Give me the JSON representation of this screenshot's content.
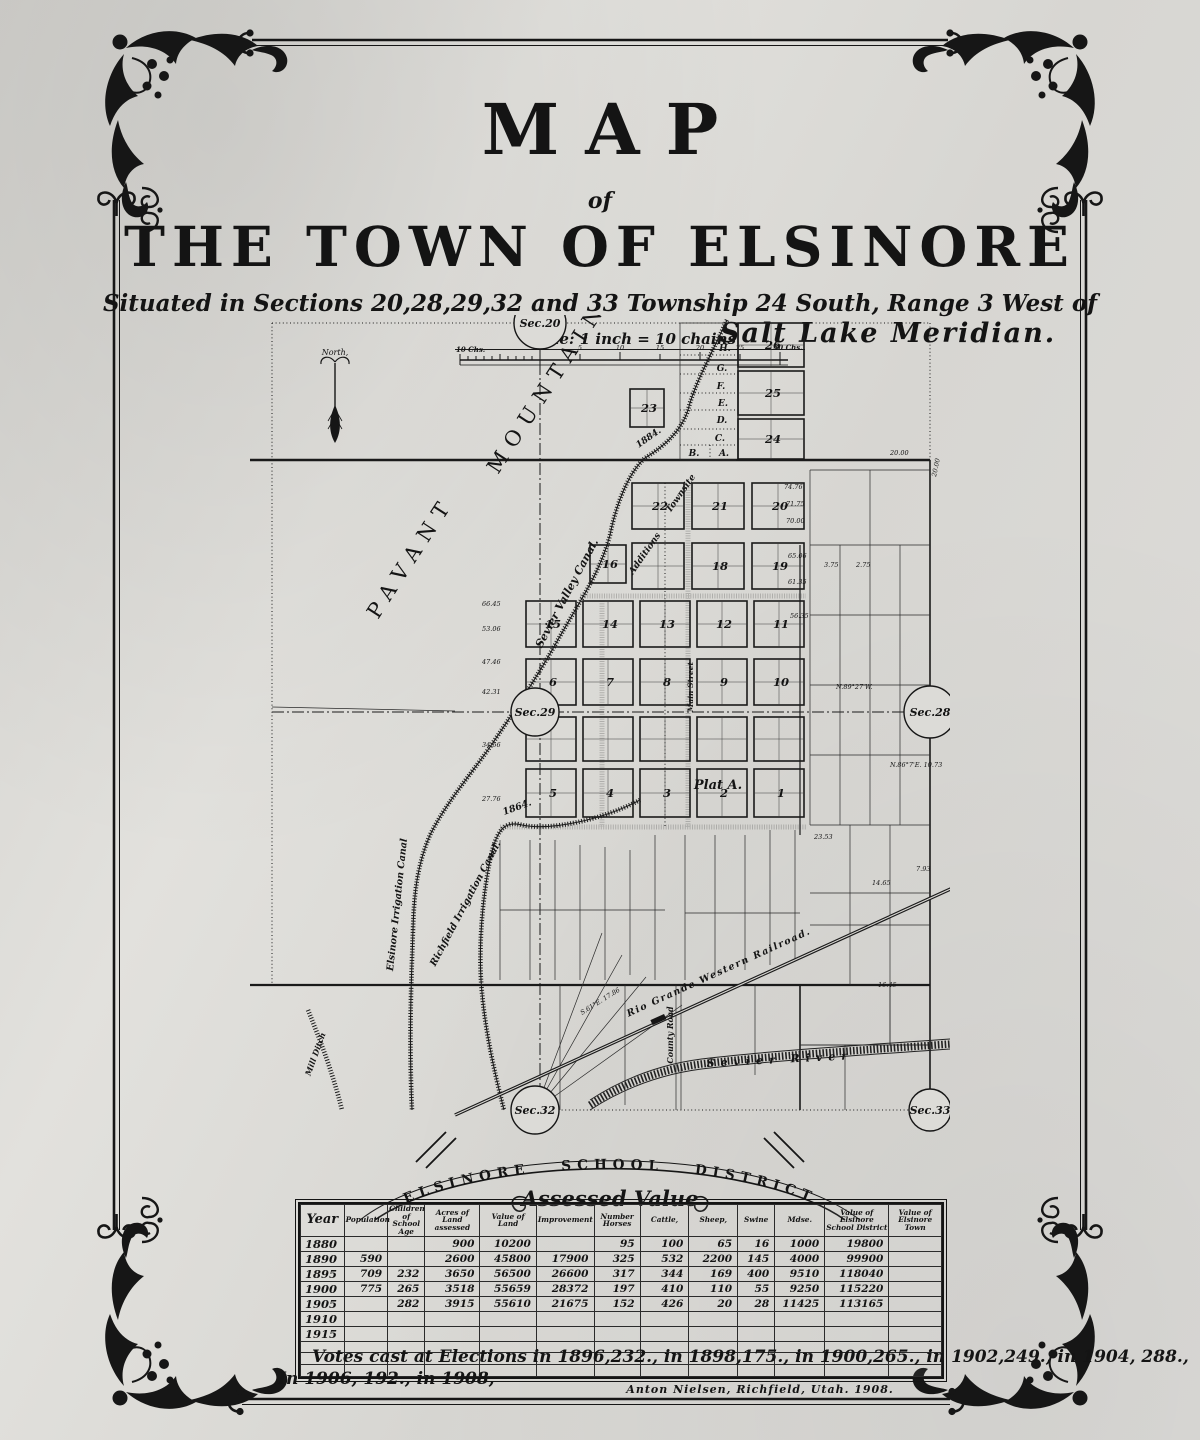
{
  "title": {
    "map": "MAP",
    "of": "of",
    "town": "THE TOWN OF ELSINORE"
  },
  "subtitle": {
    "line1": "Situated in Sections 20,28,29,32 and 33 Township 24 South, Range 3 West of",
    "line2": "Salt Lake Meridian."
  },
  "scale": {
    "label": "Scale: 1 inch = 10 chains",
    "left_end": "10 Chs.",
    "ticks": [
      "0",
      "5",
      "10",
      "15",
      "20",
      "25"
    ],
    "right_end": "30 Chs."
  },
  "map": {
    "north": "North,",
    "pavant": "PAVANT",
    "mountains": "MOUNTAINS.",
    "sec20": "Sec.20",
    "sec29": "Sec.29",
    "sec28": "Sec.28",
    "sec32": "Sec.32",
    "sec33": "Sec.33",
    "canal_sevier_valley": "Sevier Valley Canal.",
    "canal_sevier_year": "1884.",
    "canal_elsinore": "Elsinore Irrigation Canal",
    "canal_richfield": "Richfield Irrigation Canal.",
    "canal_richfield_year": "1864.",
    "mill_ditch": "Mill Ditch",
    "railroad": "Rio Grande Western Railroad.",
    "river": "Sevier River",
    "county_road": "County Road",
    "plat_a": "Plat A.",
    "main_street": "Main Street",
    "townsite": "Townsite",
    "additions": "Additions",
    "blocks": [
      "26",
      "25",
      "24",
      "23",
      "22",
      "21",
      "20",
      "16",
      "18",
      "19",
      "15",
      "14",
      "13",
      "12",
      "11",
      "6",
      "7",
      "8",
      "9",
      "10",
      "5",
      "4",
      "3",
      "2",
      "1"
    ],
    "letters": [
      "H",
      "G",
      "F",
      "E",
      "D",
      "C",
      "B",
      "A"
    ],
    "measures": [
      "20.00",
      "66.45",
      "53.06",
      "47.46",
      "42.31",
      "34.56",
      "27.76",
      "74.76",
      "71.75",
      "70.00",
      "65.06",
      "61.35",
      "56.35",
      "23.53",
      "16.45",
      "14.65",
      "7.93",
      "3.75",
      "2.75",
      "N.89°27'W.",
      "N.86°7'E. 10.73",
      "S.61°E. 17.86",
      "20.00"
    ]
  },
  "district": {
    "arc": "ELSINORE SCHOOL DISTRICT",
    "subtitle": "Assessed Value"
  },
  "table": {
    "headers": [
      "Year",
      "Population",
      "Children\nof\nSchool Age",
      "Acres of Land\nassessed",
      "Value of\nLand",
      "Improvement",
      "Number\nHorses",
      "Cattle,",
      "Sheep,",
      "Swine",
      "Mdse.",
      "Value of Elsinore\nSchool District",
      "Value of\nElsinore Town"
    ],
    "rows": [
      [
        "1880",
        "",
        "",
        "900",
        "10200",
        "",
        "95",
        "100",
        "65",
        "16",
        "1000",
        "19800",
        ""
      ],
      [
        "1890",
        "590",
        "",
        "2600",
        "45800",
        "17900",
        "325",
        "532",
        "2200",
        "145",
        "4000",
        "99900",
        ""
      ],
      [
        "1895",
        "709",
        "232",
        "3650",
        "56500",
        "26600",
        "317",
        "344",
        "169",
        "400",
        "9510",
        "118040",
        ""
      ],
      [
        "1900",
        "775",
        "265",
        "3518",
        "55659",
        "28372",
        "197",
        "410",
        "110",
        "55",
        "9250",
        "115220",
        ""
      ],
      [
        "1905",
        "",
        "282",
        "3915",
        "55610",
        "21675",
        "152",
        "426",
        "20",
        "28",
        "11425",
        "113165",
        ""
      ],
      [
        "1910",
        "",
        "",
        "",
        "",
        "",
        "",
        "",
        "",
        "",
        "",
        "",
        ""
      ],
      [
        "1915",
        "",
        "",
        "",
        "",
        "",
        "",
        "",
        "",
        "",
        "",
        "",
        ""
      ],
      [
        "",
        "",
        "",
        "",
        "",
        "",
        "",
        "",
        "",
        "",
        "",
        "",
        ""
      ],
      [
        "",
        "",
        "",
        "",
        "",
        "",
        "",
        "",
        "",
        "",
        "",
        "",
        ""
      ],
      [
        "",
        "",
        "",
        "",
        "",
        "",
        "",
        "",
        "",
        "",
        "",
        "",
        ""
      ]
    ]
  },
  "votes": {
    "line1": "Votes cast at Elections in 1896,232., in 1898,175., in 1900,265., in 1902,249., in 1904, 288.,",
    "line2": "In 1906, 192., in 1908,"
  },
  "credit": "Anton Nielsen,   Richfield,   Utah.   1908."
}
